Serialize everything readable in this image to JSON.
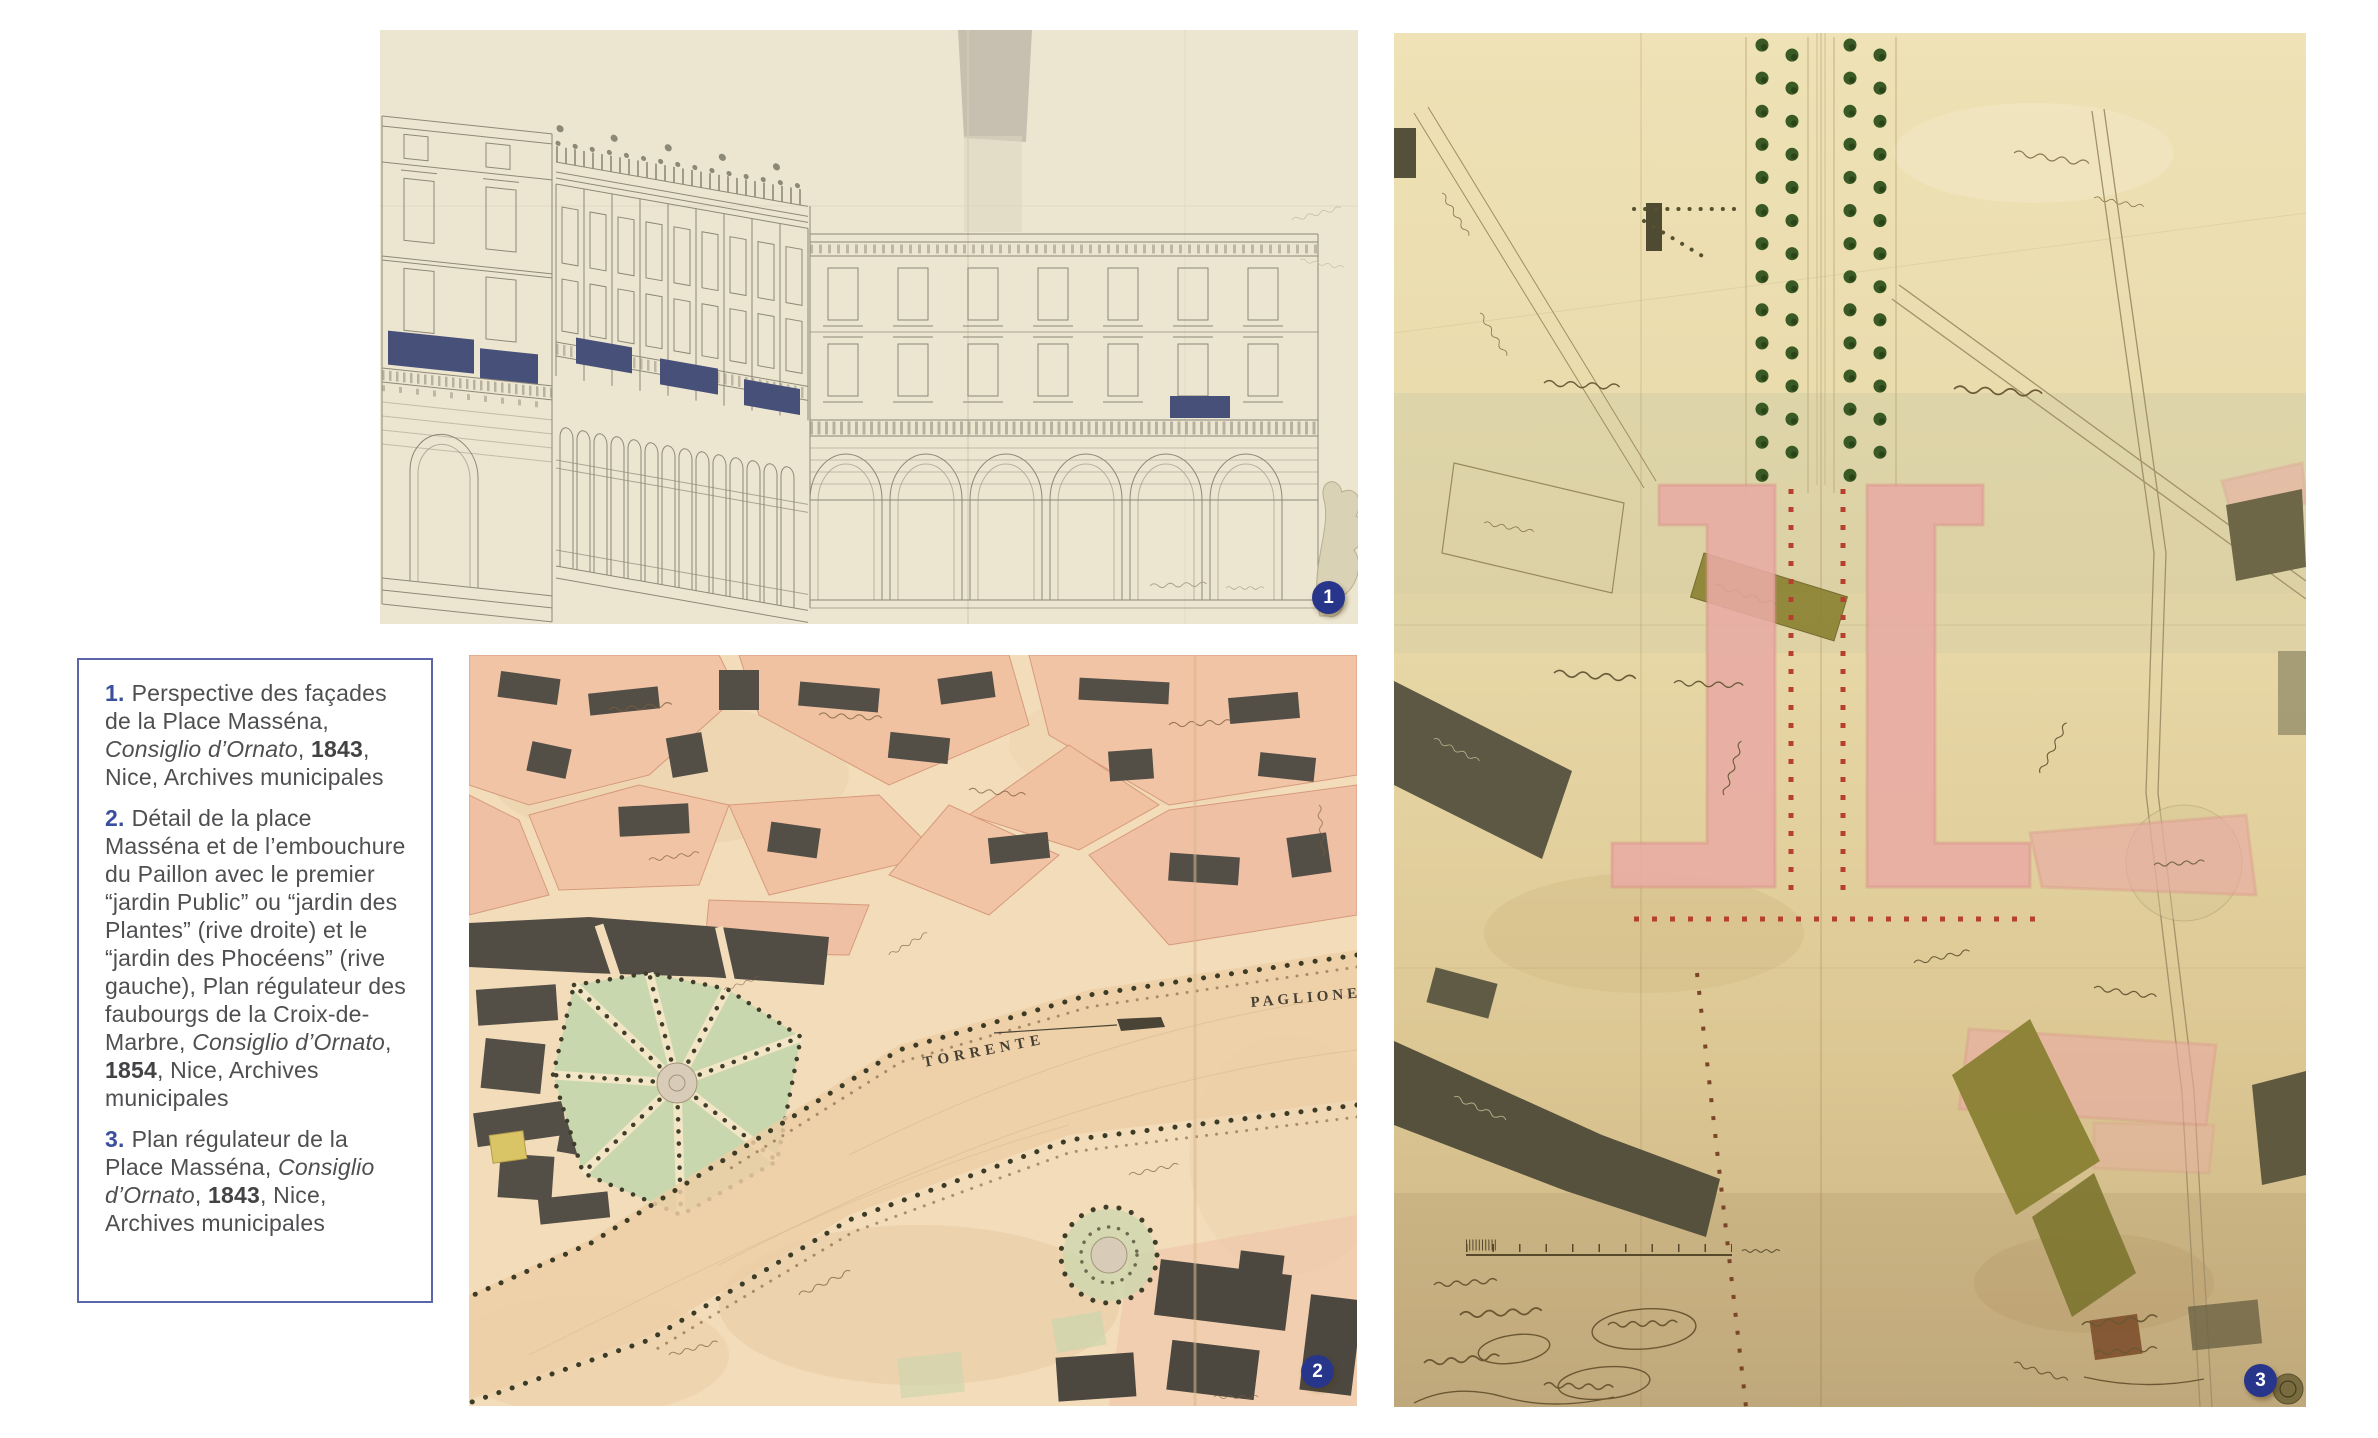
{
  "page": {
    "background": "#ffffff"
  },
  "colors": {
    "badge_blue": "#27358b",
    "caption_border": "#5a66a8",
    "caption_number_blue": "#3a4f9e",
    "caption_text": "#4f4f52"
  },
  "figures": {
    "fig1": {
      "number": "1"
    },
    "fig2": {
      "number": "2",
      "labels": {
        "torrente": "TORRENTE",
        "paglione": "PAGLIONE"
      }
    },
    "fig3": {
      "number": "3"
    }
  },
  "caption_panel": {
    "items": [
      {
        "num": "1.",
        "body": "Perspective des façades de la Place Masséna, ",
        "italic": "Consiglio d’Ornato",
        "sep": ", ",
        "year": "1843",
        "tail": ", Nice, Archives municipales"
      },
      {
        "num": "2.",
        "body": "Détail de la place Masséna et de l’embouchure du Paillon avec le premier “jardin Public” ou “jardin des Plantes” (rive droite) et le “jardin des Phocéens” (rive gauche), Plan régulateur des faubourgs de la Croix-de-Marbre, ",
        "italic": "Consiglio d’Ornato",
        "sep": ", ",
        "year": "1854",
        "tail": ", Nice, Archives municipales"
      },
      {
        "num": "3.",
        "body": "Plan régulateur de la Place Masséna, ",
        "italic": "Consiglio d’Ornato",
        "sep": ", ",
        "year": "1843",
        "tail": ", Nice, Archives municipales"
      }
    ]
  }
}
